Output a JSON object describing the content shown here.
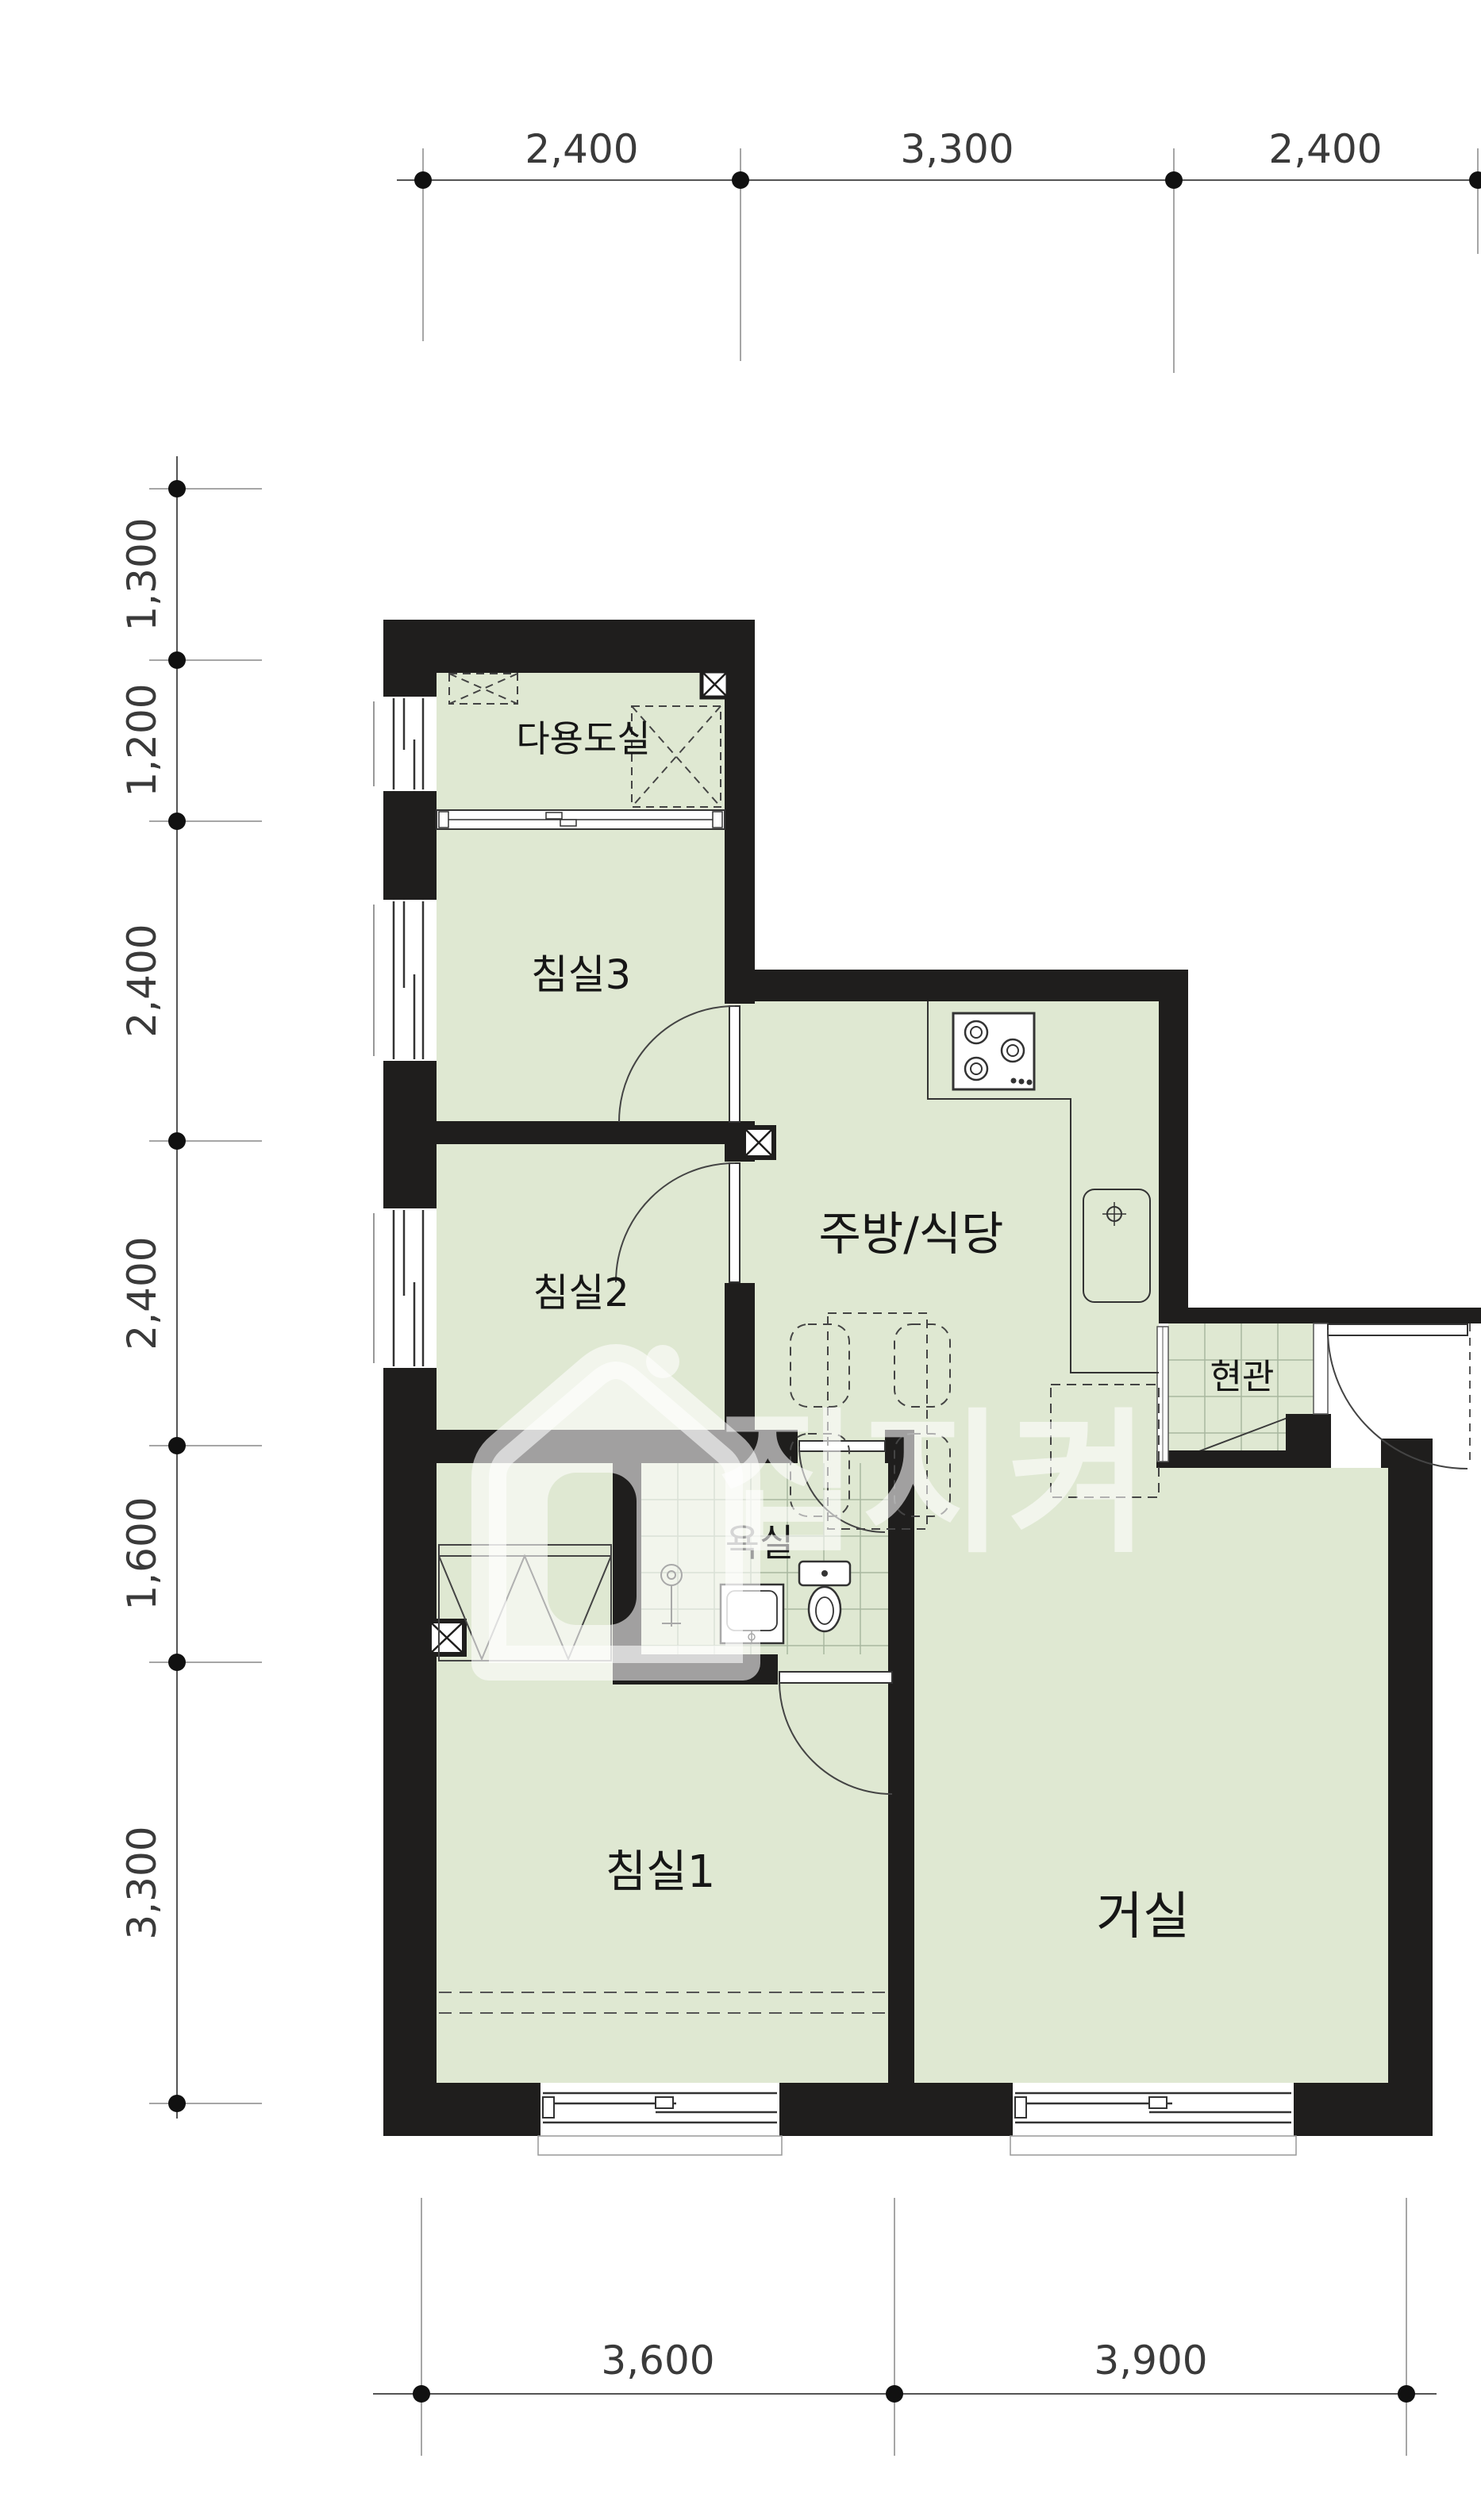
{
  "document": {
    "kind": "apartment-floor-plan",
    "language": "ko"
  },
  "dimensions": {
    "top": [
      "2,400",
      "3,300",
      "2,400"
    ],
    "left": [
      "1,300",
      "1,200",
      "2,400",
      "2,400",
      "1,600",
      "3,300"
    ],
    "bottom": [
      "3,600",
      "3,900"
    ]
  },
  "rooms": {
    "utility": {
      "label": "다용도실"
    },
    "bedroom3": {
      "label": "침실3"
    },
    "kitchen": {
      "label": "주방/식당"
    },
    "bedroom2": {
      "label": "침실2"
    },
    "bathroom": {
      "label": "욕실"
    },
    "entrance": {
      "label": "현관"
    },
    "bedroom1": {
      "label": "침실1"
    },
    "living": {
      "label": "거실"
    }
  },
  "watermark": {
    "text": "집지켜",
    "logo": "house-logo-icon"
  },
  "fixtures": [
    "stove-icon",
    "sink-icon",
    "counter-icon",
    "refrigerator-icon",
    "dining-set-icon",
    "wardrobe-icon",
    "shower-icon",
    "washbasin-icon",
    "toilet-icon",
    "shaft-icon",
    "window-icon",
    "door-swing-icon",
    "shoe-cabinet-icon"
  ],
  "colors": {
    "floor_green": "#dfe8d2",
    "wall_black": "#1f1e1d",
    "tile_line": "#a9b7a0",
    "dim_line": "#555555",
    "dashed_furniture": "#444444",
    "watermark": "rgba(255,255,255,0.58)"
  }
}
